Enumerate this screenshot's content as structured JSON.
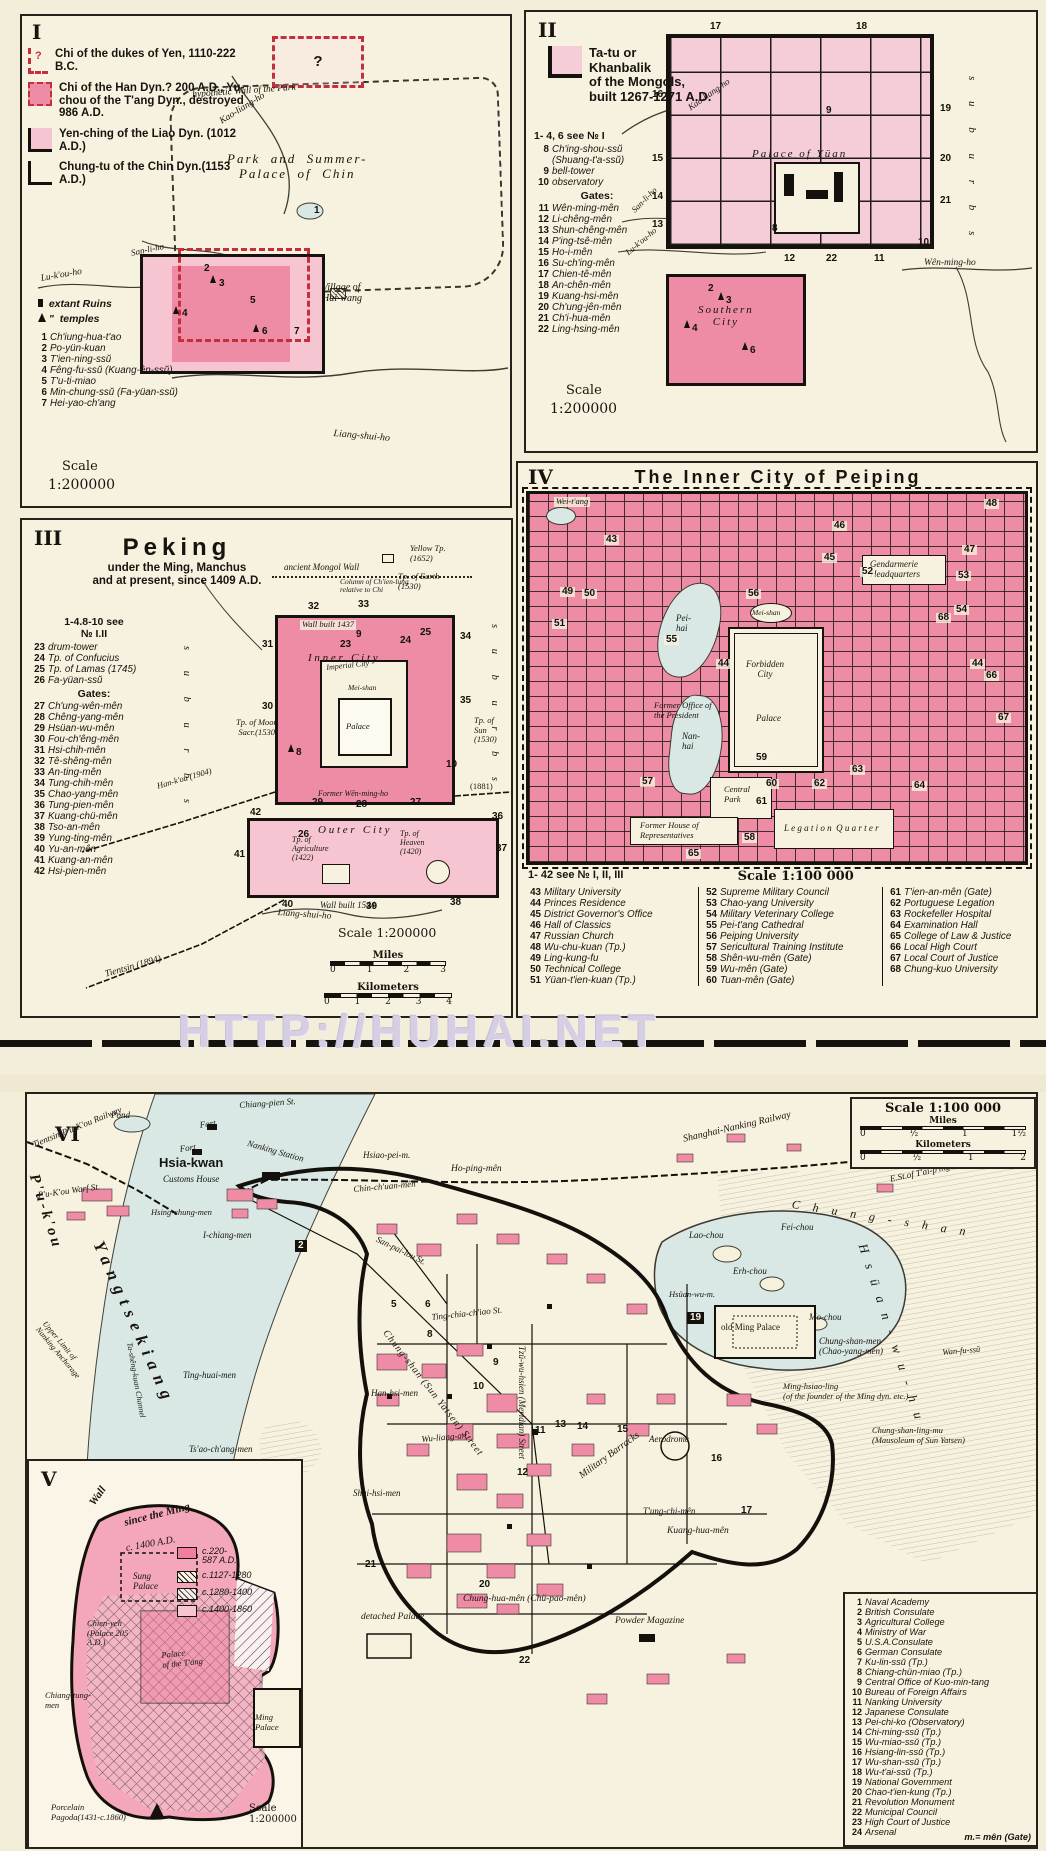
{
  "colors": {
    "paper": "#f3eed9",
    "panel": "#f7f2df",
    "ink": "#17140f",
    "pink_solid": "#ee8ba5",
    "pink_light": "#f6c5d1",
    "pink_pale": "#f5cdd9",
    "water": "#d9e8e4",
    "red_dash": "#c2303c",
    "watermark_color": "#d6cfe3"
  },
  "watermark": {
    "text": "HTTP://HUHAI.NET"
  },
  "panel_1": {
    "roman": "I",
    "legend": [
      "Chi of the dukes of Yen, 1110-222 B.C.",
      "Chi of the Han Dyn.? 200 A.D., Yu-chou of the T'ang Dyn., destroyed 986 A.D.",
      "Yen-ching of the Liao Dyn. (1012 A.D.)",
      "Chung-tu of the Chin Dyn.(1153 A.D.)"
    ],
    "legend_q": "?",
    "symbols": {
      "ruins": "extant Ruins",
      "ditto": "\"",
      "temples": "temples"
    },
    "items": [
      {
        "n": "1",
        "label": "Ch'iung-hua-t'ao"
      },
      {
        "n": "2",
        "label": "Po-yün-kuan"
      },
      {
        "n": "3",
        "label": "T'ien-ning-ssŭ"
      },
      {
        "n": "4",
        "label": "Fêng-fu-ssŭ (Kuang-ên-ssŭ)"
      },
      {
        "n": "5",
        "label": "T'u-ti-miao"
      },
      {
        "n": "6",
        "label": "Min-chung-ssŭ (Fa-yüan-ssŭ)"
      },
      {
        "n": "7",
        "label": "Hei-yao-ch'ang"
      }
    ],
    "labels": {
      "wall": "hypothetic Wall of the Park",
      "park": "Park  and  Summer-\nPalace  of  Chin",
      "village": "Village of\nHai-wang",
      "kao": "Kao-liang-ho",
      "sanli": "San-li-ho",
      "lu": "Lu-k'ou-ho",
      "liang": "Liang-shui-ho"
    },
    "scale": {
      "title": "Scale",
      "value": "1:200000"
    },
    "markers": {
      "q": "?",
      "m1": "1",
      "m2": "2",
      "m3": "3",
      "m4": "4",
      "m5": "5",
      "m6": "6",
      "m7": "7"
    }
  },
  "panel_2": {
    "roman": "II",
    "title_lines": [
      "Ta-tu or",
      "Khanbalik",
      "of the Mongols,",
      "built 1267-1271 A.D."
    ],
    "see_note": "1- 4, 6 see № I",
    "items": [
      {
        "n": "8",
        "label": "Ch'ing-shou-ssŭ (Shuang-t'a-ssŭ)"
      },
      {
        "n": "9",
        "label": "bell-tower"
      },
      {
        "n": "10",
        "label": "observatory"
      }
    ],
    "gates_heading": "Gates:",
    "gates": [
      {
        "n": "11",
        "label": "Wên-ming-mên"
      },
      {
        "n": "12",
        "label": "Li-chêng-mên"
      },
      {
        "n": "13",
        "label": "Shun-chêng-mên"
      },
      {
        "n": "14",
        "label": "P'ing-tsê-mên"
      },
      {
        "n": "15",
        "label": "Ho-i-mên"
      },
      {
        "n": "16",
        "label": "Su-ch'ing-mên"
      },
      {
        "n": "17",
        "label": "Chien-tê-mên"
      },
      {
        "n": "18",
        "label": "An-chên-mên"
      },
      {
        "n": "19",
        "label": "Kuang-hsi-mên"
      },
      {
        "n": "20",
        "label": "Ch'ung-jên-mên"
      },
      {
        "n": "21",
        "label": "Ch'i-hua-mên"
      },
      {
        "n": "22",
        "label": "Ling-hsing-mên"
      }
    ],
    "labels": {
      "palace": "Palace of Yüan",
      "southern": "Southern\nCity",
      "suburbs": "s u b u r b s",
      "kao": "Kao-liang-ho",
      "sanli": "San-li-ho",
      "lu": "Lu-k'ou-ho",
      "wenming": "Wên-ming-ho"
    },
    "scale": {
      "title": "Scale",
      "value": "1:200000"
    },
    "markers": {
      "m2": "2",
      "m3": "3",
      "m4": "4",
      "m6": "6",
      "m8": "8",
      "m9": "9",
      "m10": "10",
      "m11": "11",
      "m12": "12",
      "m13": "13",
      "m14": "14",
      "m15": "15",
      "m16": "16",
      "m17": "17",
      "m18": "18",
      "m19": "19",
      "m20": "20",
      "m21": "21",
      "m22": "22"
    }
  },
  "panel_3": {
    "roman": "III",
    "title": "Peking",
    "subtitle_lines": [
      "under the Ming, Manchus",
      "and at present, since 1409 A.D."
    ],
    "see_note": "1-4.8-10 see\n№ I.II",
    "items": [
      {
        "n": "23",
        "label": "drum-tower"
      },
      {
        "n": "24",
        "label": "Tp. of Confucius"
      },
      {
        "n": "25",
        "label": "Tp. of Lamas (1745)"
      },
      {
        "n": "26",
        "label": "Fa-yüan-ssŭ"
      }
    ],
    "gates_heading": "Gates:",
    "gates": [
      {
        "n": "27",
        "label": "Ch'ung-wên-mên"
      },
      {
        "n": "28",
        "label": "Chêng-yang-mên"
      },
      {
        "n": "29",
        "label": "Hsüan-wu-mên"
      },
      {
        "n": "30",
        "label": "Fou-ch'êng-mên"
      },
      {
        "n": "31",
        "label": "Hsi-chih-mên"
      },
      {
        "n": "32",
        "label": "Tê-shêng-mên"
      },
      {
        "n": "33",
        "label": "An-ting-mên"
      },
      {
        "n": "34",
        "label": "Tung-chih-mên"
      },
      {
        "n": "35",
        "label": "Chao-yang-mên"
      },
      {
        "n": "36",
        "label": "Tung-pien-mên"
      },
      {
        "n": "37",
        "label": "Kuang-chü-mên"
      },
      {
        "n": "38",
        "label": "Tso-an-mên"
      },
      {
        "n": "39",
        "label": "Yung-ting-mên"
      },
      {
        "n": "40",
        "label": "Yu-an-mên"
      },
      {
        "n": "41",
        "label": "Kuang-an-mên"
      },
      {
        "n": "42",
        "label": "Hsi-pien-mên"
      }
    ],
    "labels": {
      "mongol": "ancient Mongol Wall",
      "column": "Column of Ch'ien-lung\nrelative to Chi",
      "yellow": "Yellow Tp.\n(1652)",
      "earth": "Tp. of Earth\n(1530)",
      "wall1437": "Wall built 1437",
      "inner": "I n n e r   C i t y",
      "imperial": "Imperial City",
      "meishan": "Mei-shan",
      "palace": "Palace",
      "moon": "Tp. of Moon\nSacr.(1530)",
      "sun": "Tp. of\nSun\n(1530)",
      "wenming": "Former Wên-ming-ho",
      "hankou": "Han-k'ou (1904)",
      "y1881": "(1881)",
      "outer": "O u t e r   C i t y",
      "agri": "Tp. of\nAgriculture\n(1422)",
      "heaven": "Tp. of\nHeaven\n(1420)",
      "wall1544": "Wall built 1544",
      "liang": "Liang-shui-ho",
      "tientsin": "Tientsin (1894)",
      "suburbs": "s u b u r b s"
    },
    "scale": {
      "title": "Scale 1:200000",
      "miles": "Miles",
      "miles_ticks": [
        "0",
        "1",
        "2",
        "3"
      ],
      "km": "Kilometers",
      "km_ticks": [
        "0",
        "1",
        "2",
        "3",
        "4"
      ]
    },
    "markers": {
      "m8": "8",
      "m9": "9",
      "m10": "10",
      "m23": "23",
      "m24": "24",
      "m25": "25",
      "m26": "26",
      "m27": "27",
      "m28": "28",
      "m29": "29",
      "m30": "30",
      "m31": "31",
      "m32": "32",
      "m33": "33",
      "m34": "34",
      "m35": "35",
      "m36": "36",
      "m37": "37",
      "m38": "38",
      "m39": "39",
      "m40": "40",
      "m41": "41",
      "m42": "42"
    }
  },
  "panel_4": {
    "roman": "IV",
    "title": "The Inner City of Peiping",
    "labels": {
      "weitang": "Wei-t'ang",
      "peihai": "Pei-\nhai",
      "nanhai": "Nan-\nhai",
      "meishan": "Mei-shan",
      "gendarmerie": "Gendarmerie\nHeadquarters",
      "president": "Former Office of\nthe President",
      "forbidden": "Forbidden\nCity",
      "palace": "Palace",
      "park": "Central\nPark",
      "legation": "L e g a t i o n  Q u a r t e r",
      "house": "Former House of\nRepresentatives"
    },
    "legend_note": "1- 42 see № I, II, III",
    "scale": "Scale 1:100 000",
    "col1": [
      {
        "n": "43",
        "label": "Military University"
      },
      {
        "n": "44",
        "label": "Princes Residence"
      },
      {
        "n": "45",
        "label": "District Governor's Office"
      },
      {
        "n": "46",
        "label": "Hall of Classics"
      },
      {
        "n": "47",
        "label": "Russian Church"
      },
      {
        "n": "48",
        "label": "Wu-chu-kuan (Tp.)"
      },
      {
        "n": "49",
        "label": "Ling-kung-fu"
      },
      {
        "n": "50",
        "label": "Technical College"
      },
      {
        "n": "51",
        "label": "Yüan-t'ien-kuan (Tp.)"
      }
    ],
    "col2": [
      {
        "n": "52",
        "label": "Supreme Military Council"
      },
      {
        "n": "53",
        "label": "Chao-yang University"
      },
      {
        "n": "54",
        "label": "Military Veterinary College"
      },
      {
        "n": "55",
        "label": "Pei-t'ang Cathedral"
      },
      {
        "n": "56",
        "label": "Peiping University"
      },
      {
        "n": "57",
        "label": "Sericultural Training Institute"
      },
      {
        "n": "58",
        "label": "Shên-wu-mên (Gate)"
      },
      {
        "n": "59",
        "label": "Wu-mên (Gate)"
      },
      {
        "n": "60",
        "label": "Tuan-mên (Gate)"
      }
    ],
    "col3": [
      {
        "n": "61",
        "label": "T'ien-an-mên (Gate)"
      },
      {
        "n": "62",
        "label": "Portuguese Legation"
      },
      {
        "n": "63",
        "label": "Rockefeller Hospital"
      },
      {
        "n": "64",
        "label": "Examination Hall"
      },
      {
        "n": "65",
        "label": "College of Law & Justice"
      },
      {
        "n": "66",
        "label": "Local High Court"
      },
      {
        "n": "67",
        "label": "Local Court of Justice"
      },
      {
        "n": "68",
        "label": "Chung-kuo University"
      }
    ],
    "markers": {
      "m43": "43",
      "m44": "44",
      "m45": "45",
      "m46": "46",
      "m47": "47",
      "m48": "48",
      "m49": "49",
      "m50": "50",
      "m51": "51",
      "m52": "52",
      "m53": "53",
      "m54": "54",
      "m55": "55",
      "m56": "56",
      "m57": "57",
      "m58": "58",
      "m59": "59",
      "m60": "60",
      "m61": "61",
      "m62": "62",
      "m63": "63",
      "m64": "64",
      "m65": "65",
      "m66": "66",
      "m67": "67",
      "m68": "68"
    }
  },
  "panel_5": {
    "roman": "V",
    "wall_lines": [
      "Wall",
      "since the Ming",
      "c. 1400 A.D."
    ],
    "legend": [
      "c.220-\n587 A.D.",
      "c.1127-1280",
      "c.1280-1400",
      "c.1400-1860"
    ],
    "labels": {
      "sung": "Sung\nPalace",
      "chienyeh": "Chien-yeh\n(Palace 205\nA.D.)",
      "tang": "Palace\nof the T'ang",
      "chiangtung": "Chiang-tung-\nmen",
      "ming": "Ming\nPalace",
      "pagoda": "Porcelain\nPagoda(1431-c.1860)",
      "scale": "Scale\n1:200000"
    }
  },
  "panel_6": {
    "roman": "VI",
    "scale": {
      "title": "Scale 1:100 000",
      "miles": "Miles",
      "miles_ticks": [
        "0",
        "½",
        "1",
        "1½"
      ],
      "km": "Kilometers",
      "km_ticks": [
        "0",
        "½",
        "1",
        "2"
      ]
    },
    "labels": {
      "pukou": "P'u-k'ou",
      "pond": "Pond",
      "fort1": "Fort",
      "fort2": "Fort",
      "tp_railway": "Tientsin-P'u-K'ou Railway",
      "wharf": "P'u-K'ou Warf St.",
      "hsiakwan": "Hsia-kwan",
      "customs": "Customs House",
      "chiangpien": "Chiang-pien St.",
      "station": "Nanking Station",
      "ichiang": "I-chiang-men",
      "hsingchung": "Hsing-chung-men",
      "hsiaopei": "Hsiao-pei-m.",
      "hoping": "Ho-ping-mên",
      "chinchuan": "Chin-ch'uan-mên",
      "shanghai_rwy": "Shanghai-Nanking Railway",
      "taiping": "E.St.of T'ai-p'ing-mên",
      "sanpailou": "San-pai-lou St.",
      "tingchia": "Ting-chia-ch'iao St.",
      "chungshan_st": "Chung-shan (Sun Yatsen) Street",
      "meridian": "Tzŭ-wu-hsien (Meridian) Street",
      "wuliang": "Wu-liang-an",
      "barracks": "Military Barracks",
      "mingpalace": "old Ming Palace",
      "aerodrome": "Aerodrome",
      "kuanghua": "Kuang-hua-mên",
      "tungchi": "T'ung-chi-mên",
      "chunghua": "Chung-hua-mên (Chü-pao-mên)",
      "detached": "detached Palace",
      "powder": "Powder Magazine",
      "chungshanmen": "Chung-shan-men\n(Chao-yang-men)",
      "minghsiaoling": "Ming-hsiao-ling\n(of the founder of the Ming dyn. etc.)",
      "sunyatsen": "Chung-shan-ling-mu\n(Mausoleum of Sun Yatsen)",
      "wanfussu": "Wan-fu-ssŭ",
      "chungshan_mtn": "C h u n g - s h a n",
      "laochou": "Lao-chou",
      "feichou": "Fei-chou",
      "erhchou": "Erh-chou",
      "mochou": "Mo-chou",
      "hsuanwum": "Hsüan-wu-m.",
      "lake": "H s ü a n - w u - h u",
      "tinghuai": "Ting-huai-men",
      "tsaochang": "Ts'ao-ch'ang-men",
      "hanhsi": "Han-hsi-men",
      "shuihsi": "Shui-hsi-men",
      "yangtze": "Yangtsekiang",
      "anchorage": "Upper Limit of\nNanking Anchorage",
      "channel": "Ta-shêng-kuan Channel"
    },
    "list": [
      {
        "n": "1",
        "label": "Naval Academy"
      },
      {
        "n": "2",
        "label": "British Consulate"
      },
      {
        "n": "3",
        "label": "Agricultural College"
      },
      {
        "n": "4",
        "label": "Ministry of War"
      },
      {
        "n": "5",
        "label": "U.S.A.Consulate"
      },
      {
        "n": "6",
        "label": "German Consulate"
      },
      {
        "n": "7",
        "label": "Ku-lin-ssŭ (Tp.)"
      },
      {
        "n": "8",
        "label": "Chiang-chün-miao (Tp.)"
      },
      {
        "n": "9",
        "label": "Central Office of Kuo-min-tang"
      },
      {
        "n": "10",
        "label": "Bureau of Foreign Affairs"
      },
      {
        "n": "11",
        "label": "Nanking University"
      },
      {
        "n": "12",
        "label": "Japanese Consulate"
      },
      {
        "n": "13",
        "label": "Pei-chi-ko (Observatory)"
      },
      {
        "n": "14",
        "label": "Chi-ming-ssŭ (Tp.)"
      },
      {
        "n": "15",
        "label": "Wu-miao-ssŭ (Tp.)"
      },
      {
        "n": "16",
        "label": "Hsiang-lin-ssŭ (Tp.)"
      },
      {
        "n": "17",
        "label": "Wu-shan-ssŭ (Tp.)"
      },
      {
        "n": "18",
        "label": "Wu-t'ai-ssŭ (Tp.)"
      },
      {
        "n": "19",
        "label": "National Government"
      },
      {
        "n": "20",
        "label": "Chao-t'ien-kung (Tp.)"
      },
      {
        "n": "21",
        "label": "Revolution Monument"
      },
      {
        "n": "22",
        "label": "Municipal Council"
      },
      {
        "n": "23",
        "label": "High Court of Justice"
      },
      {
        "n": "24",
        "label": "Arsenal"
      }
    ],
    "footnote": "m.= mên (Gate)",
    "markers": {
      "m2": "2",
      "m5": "5",
      "m6": "6",
      "m8": "8",
      "m9": "9",
      "m10": "10",
      "m11": "11",
      "m12": "12",
      "m13": "13",
      "m14": "14",
      "m15": "15",
      "m16": "16",
      "m17": "17",
      "m19": "19",
      "m20": "20",
      "m21": "21",
      "m22": "22"
    }
  }
}
